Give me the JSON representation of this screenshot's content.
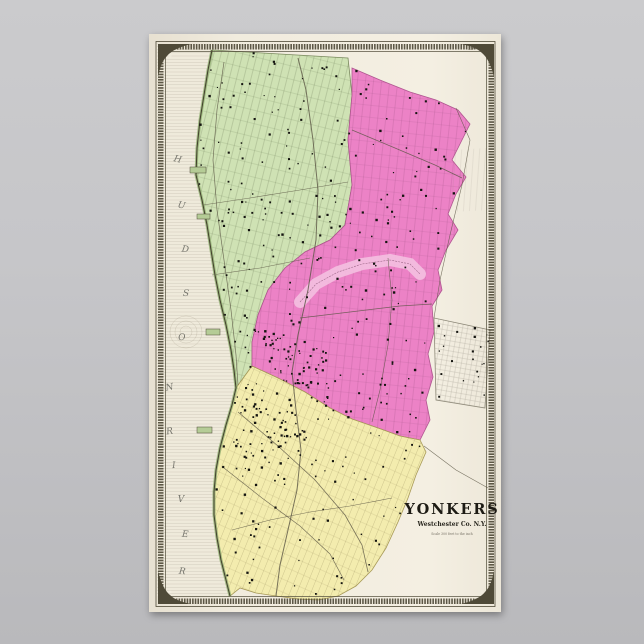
{
  "poster": {
    "background_top": "#cbcbcd",
    "background_bottom": "#b9b9bc",
    "paper_color": "#f4efe2"
  },
  "map": {
    "title": "YONKERS",
    "subtitle": "Westchester Co. N.Y.",
    "scale_note": "Scale 300 feet to the inch",
    "page_number": "39",
    "frame_color": "#4f4a38",
    "ink_color": "#141410",
    "river_label": {
      "word1": "HUDSON",
      "word2": "RIVER",
      "letters": [
        {
          "ch": "H",
          "x": 177,
          "y": 162,
          "r": 14
        },
        {
          "ch": "U",
          "x": 181,
          "y": 208,
          "r": 12
        },
        {
          "ch": "D",
          "x": 185,
          "y": 252,
          "r": 8
        },
        {
          "ch": "S",
          "x": 186,
          "y": 296,
          "r": 2
        },
        {
          "ch": "O",
          "x": 182,
          "y": 340,
          "r": -4
        },
        {
          "ch": "N",
          "x": 170,
          "y": 390,
          "r": -10
        },
        {
          "ch": "R",
          "x": 170,
          "y": 434,
          "r": -8
        },
        {
          "ch": "I",
          "x": 174,
          "y": 468,
          "r": -4
        },
        {
          "ch": "V",
          "x": 181,
          "y": 502,
          "r": 0
        },
        {
          "ch": "E",
          "x": 185,
          "y": 537,
          "r": 4
        },
        {
          "ch": "R",
          "x": 182,
          "y": 574,
          "r": 6
        }
      ]
    },
    "regions": [
      {
        "name": "northwest-ward",
        "color": "#cfe2b4",
        "outline": "#7a8a5e",
        "patterns": [
          "pGreenA",
          "pGreenB"
        ],
        "points": [
          [
            212,
            50
          ],
          [
            348,
            58
          ],
          [
            352,
            95
          ],
          [
            348,
            140
          ],
          [
            352,
            185
          ],
          [
            345,
            225
          ],
          [
            330,
            240
          ],
          [
            305,
            252
          ],
          [
            285,
            268
          ],
          [
            268,
            290
          ],
          [
            258,
            315
          ],
          [
            252,
            342
          ],
          [
            252,
            366
          ],
          [
            236,
            388
          ],
          [
            234,
            370
          ],
          [
            231,
            350
          ],
          [
            226,
            325
          ],
          [
            220,
            300
          ],
          [
            215,
            275
          ],
          [
            211,
            250
          ],
          [
            207,
            225
          ],
          [
            202,
            200
          ],
          [
            196,
            175
          ],
          [
            197,
            148
          ],
          [
            200,
            120
          ],
          [
            204,
            95
          ],
          [
            208,
            70
          ]
        ]
      },
      {
        "name": "northeast-ward",
        "color": "#ec82c6",
        "outline": "#b05690",
        "patterns": [
          "pPinkA",
          "pPinkB"
        ],
        "points": [
          [
            352,
            68
          ],
          [
            380,
            80
          ],
          [
            410,
            92
          ],
          [
            436,
            100
          ],
          [
            458,
            110
          ],
          [
            470,
            124
          ],
          [
            461,
            142
          ],
          [
            452,
            160
          ],
          [
            466,
            177
          ],
          [
            456,
            194
          ],
          [
            448,
            214
          ],
          [
            458,
            230
          ],
          [
            446,
            250
          ],
          [
            438,
            270
          ],
          [
            442,
            290
          ],
          [
            432,
            306
          ],
          [
            434,
            332
          ],
          [
            428,
            354
          ],
          [
            433,
            377
          ],
          [
            426,
            400
          ],
          [
            430,
            420
          ],
          [
            420,
            440
          ],
          [
            400,
            436
          ],
          [
            378,
            428
          ],
          [
            352,
            419
          ],
          [
            330,
            408
          ],
          [
            305,
            392
          ],
          [
            278,
            378
          ],
          [
            252,
            366
          ],
          [
            252,
            342
          ],
          [
            258,
            315
          ],
          [
            268,
            290
          ],
          [
            285,
            268
          ],
          [
            305,
            252
          ],
          [
            330,
            240
          ],
          [
            345,
            225
          ],
          [
            352,
            185
          ],
          [
            348,
            140
          ],
          [
            352,
            95
          ]
        ]
      },
      {
        "name": "south-ward",
        "color": "#f3ecae",
        "outline": "#a89a58",
        "patterns": [
          "pYellowA",
          "pYellowB"
        ],
        "points": [
          [
            236,
            388
          ],
          [
            252,
            366
          ],
          [
            278,
            378
          ],
          [
            305,
            392
          ],
          [
            330,
            408
          ],
          [
            352,
            419
          ],
          [
            378,
            428
          ],
          [
            400,
            436
          ],
          [
            420,
            440
          ],
          [
            426,
            452
          ],
          [
            416,
            475
          ],
          [
            408,
            498
          ],
          [
            398,
            522
          ],
          [
            386,
            548
          ],
          [
            372,
            570
          ],
          [
            356,
            586
          ],
          [
            338,
            596
          ],
          [
            318,
            600
          ],
          [
            298,
            599
          ],
          [
            276,
            596
          ],
          [
            256,
            593
          ],
          [
            240,
            588
          ],
          [
            230,
            596
          ],
          [
            226,
            580
          ],
          [
            221,
            560
          ],
          [
            217,
            538
          ],
          [
            214,
            515
          ],
          [
            214,
            492
          ],
          [
            216,
            470
          ],
          [
            220,
            448
          ],
          [
            226,
            425
          ],
          [
            232,
            405
          ]
        ]
      },
      {
        "name": "east-village-grid",
        "color": "none",
        "outline": "#8f8a7a",
        "patterns": [
          "pGrayA"
        ],
        "points": [
          [
            434,
            318
          ],
          [
            490,
            330
          ],
          [
            485,
            408
          ],
          [
            436,
            400
          ]
        ]
      },
      {
        "name": "east-grid-upper",
        "color": "none",
        "outline": "none",
        "patterns": [
          "pGrayB"
        ],
        "points": [
          [
            452,
            150
          ],
          [
            487,
            148
          ],
          [
            489,
            210
          ],
          [
            452,
            212
          ]
        ]
      }
    ],
    "shoreline": [
      [
        212,
        50
      ],
      [
        208,
        70
      ],
      [
        204,
        95
      ],
      [
        200,
        120
      ],
      [
        197,
        148
      ],
      [
        196,
        175
      ],
      [
        202,
        200
      ],
      [
        207,
        225
      ],
      [
        211,
        250
      ],
      [
        215,
        275
      ],
      [
        220,
        300
      ],
      [
        226,
        325
      ],
      [
        231,
        350
      ],
      [
        234,
        370
      ],
      [
        236,
        388
      ],
      [
        232,
        405
      ],
      [
        226,
        425
      ],
      [
        220,
        448
      ],
      [
        216,
        470
      ],
      [
        214,
        492
      ],
      [
        214,
        515
      ],
      [
        217,
        538
      ],
      [
        221,
        560
      ],
      [
        226,
        580
      ],
      [
        230,
        596
      ]
    ],
    "river_area": [
      [
        157,
        45
      ],
      [
        212,
        50
      ],
      [
        208,
        70
      ],
      [
        204,
        95
      ],
      [
        200,
        120
      ],
      [
        197,
        148
      ],
      [
        196,
        175
      ],
      [
        202,
        200
      ],
      [
        207,
        225
      ],
      [
        211,
        250
      ],
      [
        215,
        275
      ],
      [
        220,
        300
      ],
      [
        226,
        325
      ],
      [
        231,
        350
      ],
      [
        234,
        370
      ],
      [
        236,
        388
      ],
      [
        232,
        405
      ],
      [
        226,
        425
      ],
      [
        220,
        448
      ],
      [
        216,
        470
      ],
      [
        214,
        492
      ],
      [
        214,
        515
      ],
      [
        217,
        538
      ],
      [
        221,
        560
      ],
      [
        226,
        580
      ],
      [
        230,
        596
      ],
      [
        157,
        596
      ]
    ],
    "piers": [
      {
        "x": 190,
        "y": 167,
        "w": 16,
        "h": 6
      },
      {
        "x": 197,
        "y": 214,
        "w": 13,
        "h": 5
      },
      {
        "x": 206,
        "y": 329,
        "w": 14,
        "h": 6
      },
      {
        "x": 197,
        "y": 427,
        "w": 15,
        "h": 6
      }
    ],
    "ravine": {
      "band_color": "#f4c0e0",
      "contour": "#8a5474",
      "points": [
        [
          300,
          302
        ],
        [
          316,
          284
        ],
        [
          338,
          272
        ],
        [
          362,
          264
        ],
        [
          390,
          260
        ],
        [
          410,
          264
        ],
        [
          420,
          274
        ]
      ]
    },
    "roads": [
      {
        "name": "broadway",
        "w": 1.0,
        "points": [
          [
            298,
            58
          ],
          [
            306,
            90
          ],
          [
            313,
            140
          ],
          [
            318,
            190
          ],
          [
            316,
            240
          ],
          [
            308,
            290
          ],
          [
            298,
            335
          ],
          [
            292,
            372
          ],
          [
            296,
            410
          ],
          [
            301,
            450
          ],
          [
            297,
            490
          ],
          [
            288,
            530
          ],
          [
            280,
            565
          ],
          [
            276,
            596
          ]
        ]
      },
      {
        "name": "shore-road",
        "w": 0.7,
        "points": [
          [
            224,
            62
          ],
          [
            217,
            110
          ],
          [
            213,
            160
          ],
          [
            217,
            210
          ],
          [
            224,
            260
          ],
          [
            231,
            310
          ],
          [
            236,
            355
          ],
          [
            238,
            385
          ]
        ]
      },
      {
        "name": "cross-street-north-1",
        "w": 0.6,
        "points": [
          [
            203,
            205
          ],
          [
            250,
            198
          ],
          [
            300,
            190
          ],
          [
            348,
            182
          ]
        ]
      },
      {
        "name": "cross-street-north-2",
        "w": 0.6,
        "points": [
          [
            212,
            275
          ],
          [
            260,
            268
          ],
          [
            310,
            258
          ]
        ]
      },
      {
        "name": "northeast-road",
        "w": 0.7,
        "points": [
          [
            352,
            130
          ],
          [
            395,
            148
          ],
          [
            435,
            165
          ],
          [
            462,
            178
          ]
        ]
      },
      {
        "name": "central-cross-road",
        "w": 0.7,
        "points": [
          [
            300,
            318
          ],
          [
            350,
            312
          ],
          [
            400,
            306
          ],
          [
            432,
            304
          ]
        ]
      },
      {
        "name": "east-down-road",
        "w": 0.6,
        "points": [
          [
            388,
            258
          ],
          [
            392,
            300
          ],
          [
            388,
            345
          ],
          [
            380,
            390
          ],
          [
            372,
            422
          ]
        ]
      },
      {
        "name": "south-diagonal-1",
        "w": 0.8,
        "points": [
          [
            238,
            412
          ],
          [
            278,
            446
          ],
          [
            315,
            480
          ],
          [
            345,
            515
          ],
          [
            362,
            545
          ],
          [
            368,
            572
          ]
        ]
      },
      {
        "name": "south-diagonal-2",
        "w": 0.7,
        "points": [
          [
            224,
            468
          ],
          [
            262,
            498
          ],
          [
            300,
            526
          ],
          [
            330,
            554
          ],
          [
            344,
            580
          ]
        ]
      },
      {
        "name": "south-cross-road",
        "w": 0.6,
        "points": [
          [
            232,
            530
          ],
          [
            270,
            520
          ],
          [
            310,
            512
          ],
          [
            350,
            506
          ],
          [
            392,
            498
          ]
        ]
      },
      {
        "name": "east-boundary-road",
        "w": 0.6,
        "points": [
          [
            456,
            108
          ],
          [
            470,
            140
          ],
          [
            462,
            185
          ],
          [
            450,
            235
          ],
          [
            440,
            280
          ],
          [
            434,
            318
          ]
        ]
      },
      {
        "name": "southeast-road",
        "w": 0.6,
        "points": [
          [
            424,
            446
          ],
          [
            456,
            470
          ],
          [
            488,
            488
          ]
        ]
      }
    ],
    "buildings": {
      "seed": 42,
      "groups": [
        {
          "region": 0,
          "count": 120
        },
        {
          "region": 1,
          "count": 130
        },
        {
          "region": 2,
          "count": 95
        },
        {
          "region": 3,
          "count": 22
        },
        {
          "name": "downtown-dense",
          "count": 70,
          "poly": [
            [
              262,
              330
            ],
            [
              330,
              345
            ],
            [
              330,
              410
            ],
            [
              268,
              372
            ]
          ]
        },
        {
          "name": "south-ward-dense",
          "count": 60,
          "poly": [
            [
              230,
              395
            ],
            [
              300,
              400
            ],
            [
              310,
              460
            ],
            [
              236,
              470
            ]
          ]
        }
      ]
    },
    "ripples": {
      "cx": 186,
      "cy": 332,
      "radii": [
        6,
        11,
        16
      ]
    }
  }
}
